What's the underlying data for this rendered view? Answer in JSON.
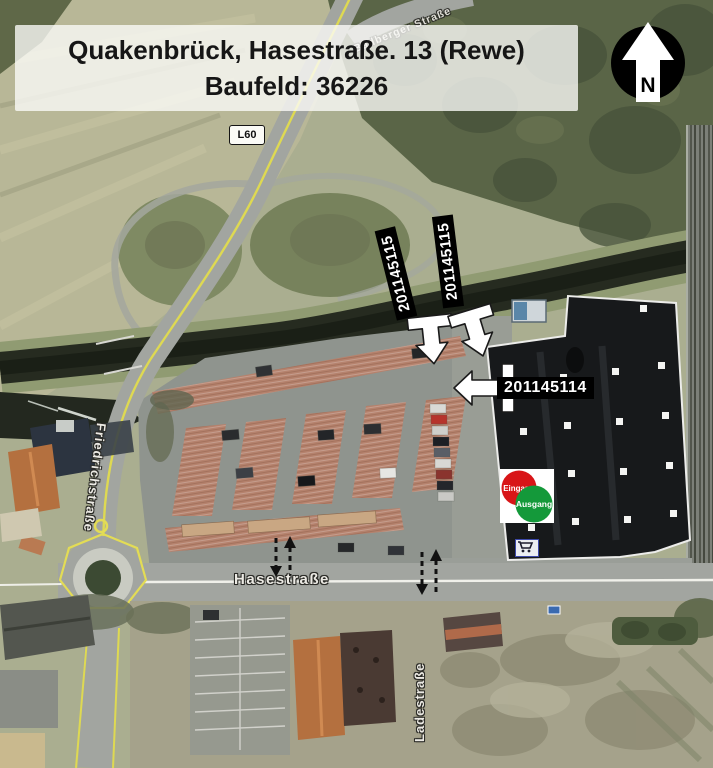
{
  "title": {
    "line1": "Quakenbrück, Hasestraße. 13 (Rewe)",
    "line2": "Baufeld: 36226"
  },
  "compass": {
    "north_label": "N"
  },
  "roads": {
    "route_badge": "L60",
    "top_street": "Badberger Straße",
    "west_street": "Friedrichstraße",
    "south_street": "Hasestraße",
    "bottom_street": "Ladestraße"
  },
  "site_labels": {
    "north_entry_left": "201145115",
    "north_entry_right": "201145115",
    "west_entry": "201145114"
  },
  "store_marker": {
    "entrance_label": "Eingang",
    "exit_label": "Ausgang",
    "entrance_color": "#d81518",
    "exit_color": "#14993a"
  },
  "colors": {
    "annotation_label_bg": "#000000",
    "annotation_label_text": "#ffffff",
    "entry_arrow_fill": "#ffffff",
    "road_centerline_yellow": "#ded952",
    "street_label_halo": "#2a2a26"
  }
}
